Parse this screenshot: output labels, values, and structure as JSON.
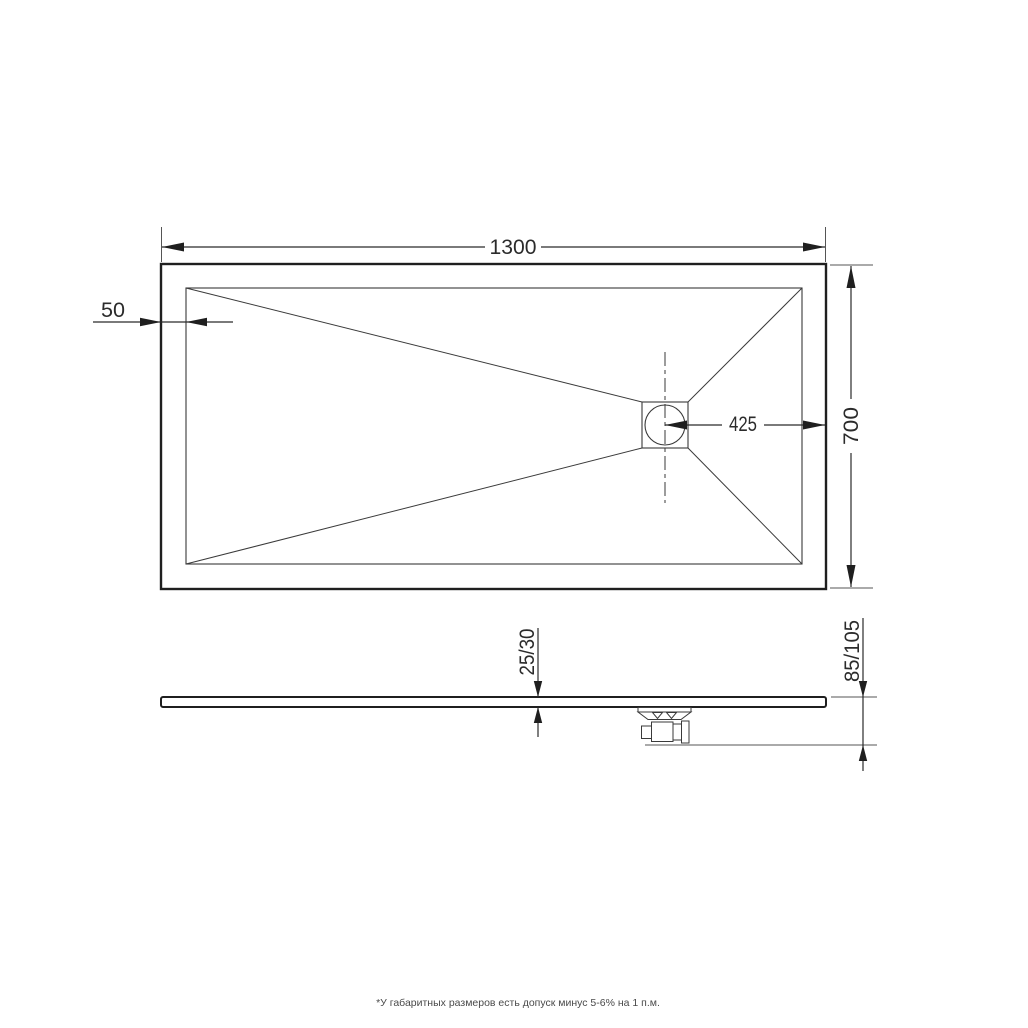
{
  "drawing": {
    "type": "technical-drawing",
    "subject": "rectangular shower tray, plan and section views",
    "colors": {
      "background": "#ffffff",
      "thick_line": "#1f1f1f",
      "thin_line": "#3a3a3a",
      "dimension_text": "#2b2b2b",
      "footnote_text": "#4a4a4a"
    },
    "top_view": {
      "length_dimension": {
        "label": "1300"
      },
      "rim_width_dimension": {
        "label": "50"
      },
      "drain_offset_dimension": {
        "label": "425"
      },
      "width_dimension": {
        "label": "700"
      }
    },
    "side_view": {
      "thickness_dimension": {
        "label": "25/30"
      },
      "total_height_dimension": {
        "label": "85/105"
      }
    },
    "footnote": "*У габаритных размеров есть допуск минус 5-6% на 1 п.м."
  }
}
